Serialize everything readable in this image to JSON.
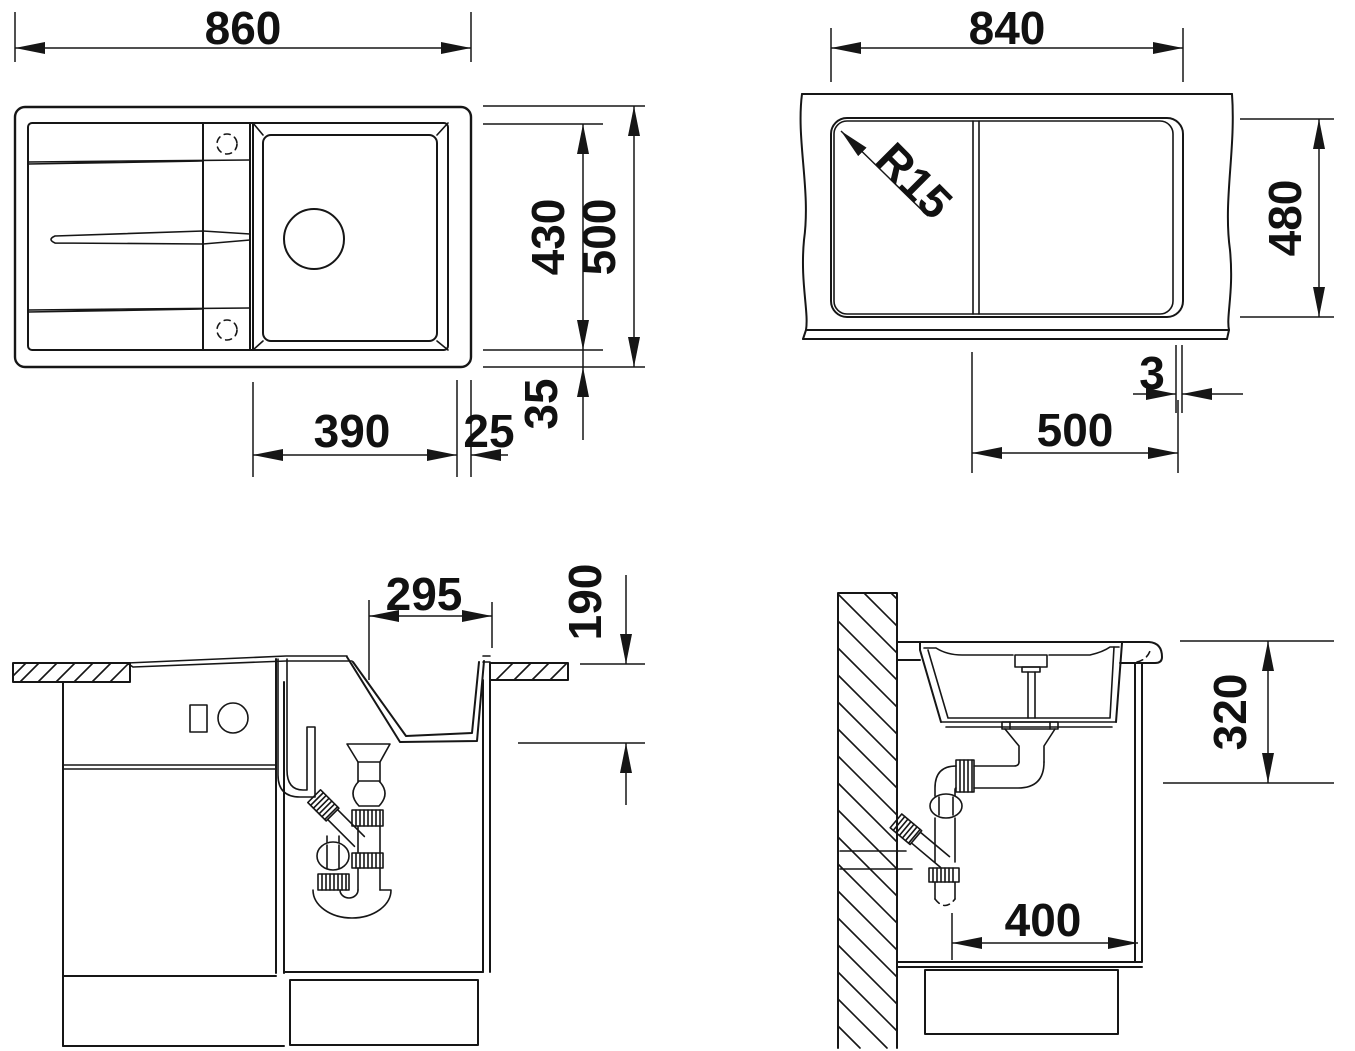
{
  "drawing": {
    "type": "sink-installation-technical-drawing",
    "line_color": "#161616",
    "background": "#ffffff"
  },
  "dims": {
    "top": {
      "width": "860",
      "basin_depth": "430",
      "depth": "500",
      "bowl_width": "390",
      "right_edge": "25",
      "bottom_edge": "35"
    },
    "cutout": {
      "width": "840",
      "depth": "480",
      "radius": "R15",
      "offset": "3",
      "bowl_width": "500"
    },
    "front": {
      "bowl_width": "295",
      "bowl_depth": "190"
    },
    "side": {
      "depth": "320",
      "clearance": "400"
    }
  }
}
